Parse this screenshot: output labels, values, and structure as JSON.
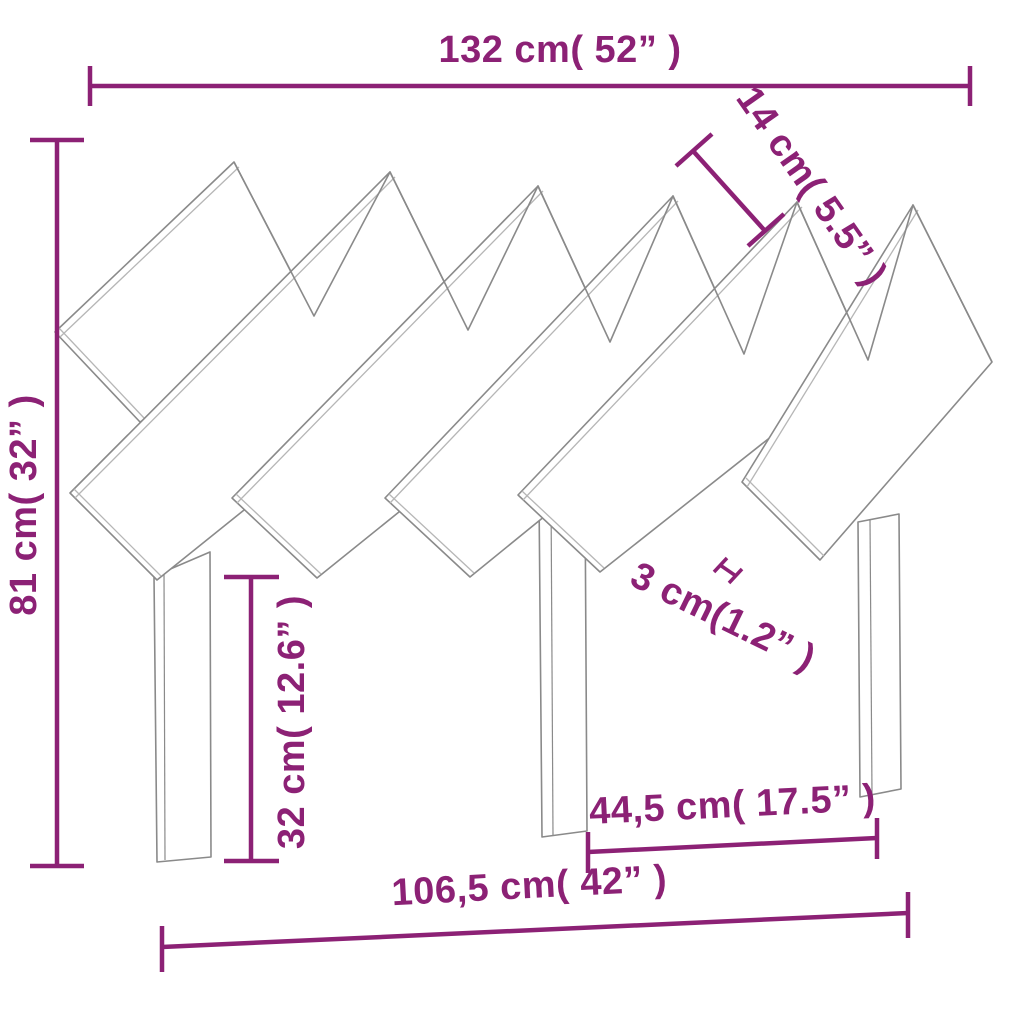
{
  "diagram": {
    "title": "headboard-dimension-diagram",
    "colors": {
      "dimension_accent": "#8C2175",
      "drawing_outline": "#8A8A8A",
      "drawing_fill": "#FFFFFF",
      "background": "#FFFFFF"
    },
    "labels": {
      "top_width": "132 cm( 52” )",
      "board_width": "14 cm( 5.5” )",
      "overall_height": "81 cm( 32” )",
      "leg_height": "32 cm( 12.6” )",
      "board_gap": "3 cm(1.2” )",
      "leg_span": "44,5 cm( 17.5” )",
      "base_width": "106,5 cm( 42” )"
    }
  }
}
